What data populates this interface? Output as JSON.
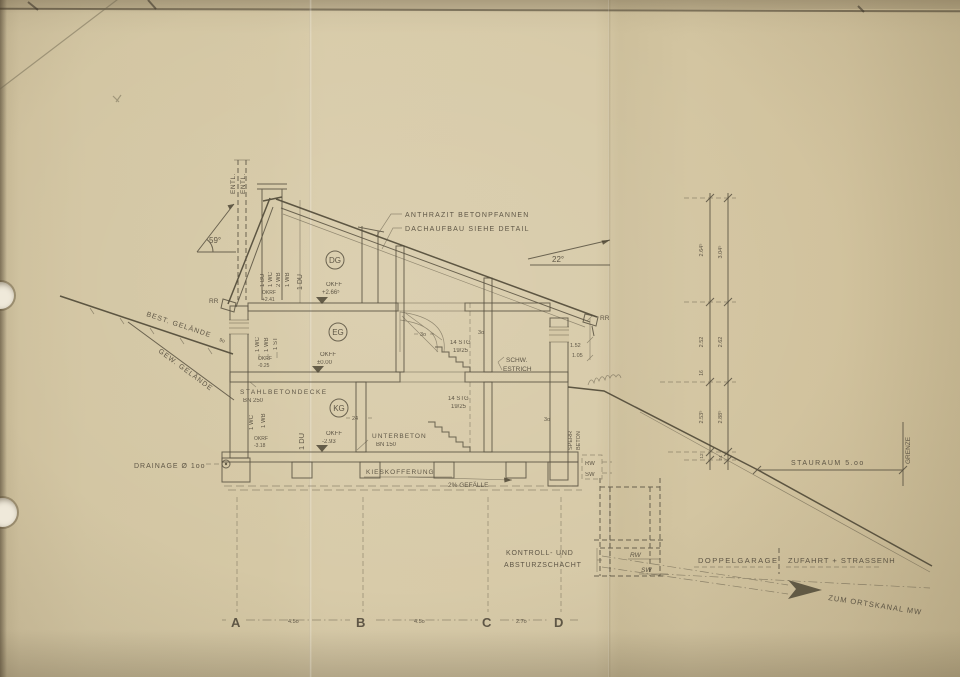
{
  "paper": {
    "bg": "#d5c8a6",
    "ink": "#57503f"
  },
  "d": {
    "vents": [
      "ENTL.",
      "ENTL."
    ],
    "angle_left": "59°",
    "angle_right": "22°",
    "roof_note1": "ANTHRAZIT BETONPFANNEN",
    "roof_note2": "DACHAUFBAU SIEHE DETAIL",
    "rr_left": "RR",
    "rr_right": "RR",
    "terrain_existing": "BEST. GELÄNDE",
    "terrain_existing_dim": "9o",
    "terrain_new": "GEW. GELÄNDE",
    "storey_dg": "DG",
    "storey_eg": "EG",
    "storey_kg": "KG",
    "lvl_dg1": "OKFF",
    "lvl_dg2": "+2.66⁵",
    "lvl_eg1": "OKFF",
    "lvl_eg2": "±0.00",
    "lvl_kg1": "OKFF",
    "lvl_kg2": "-2.93",
    "sub_dg1": "OKRF",
    "sub_dg2": "+2.41",
    "sub_eg1": "OKRF",
    "sub_eg2": "-0.25",
    "sub_kg1": "OKRF",
    "sub_kg2": "-3.18",
    "fixtures_dg": [
      "1 BU",
      "1 WC",
      "2 WB",
      "1 WB",
      "1 DU"
    ],
    "fixtures_eg": [
      "1 WC",
      "1 WB",
      "1 ST"
    ],
    "fixtures_kg": [
      "1 WC",
      "1 WB",
      "1 DU"
    ],
    "slab_note1": "STAHLBETONDECKE",
    "slab_note2": "BN 250",
    "base_note1": "UNTERBETON",
    "base_note2": "BN 150",
    "screed1": "SCHW.",
    "screed2": "ESTRICH",
    "stair1a": "14 STG",
    "stair1b": "19/25",
    "stair2a": "14 STG",
    "stair2b": "19/25",
    "wall_dims": [
      "3o",
      "3o",
      "24",
      "3o"
    ],
    "eave_dims": [
      "1.52",
      "1.05"
    ],
    "sperr1": "SPERR",
    "sperr2": "BETON",
    "rw1": "RW",
    "sw1": "SW",
    "drainage": "DRAINAGE Ø 1oo",
    "gravel": "KIESKOFFERUNG",
    "slope_note": "2% GEFÄLLE",
    "shaft1": "KONTROLL- UND",
    "shaft2": "ABSTURZSCHACHT",
    "rw2": "RW",
    "sw2": "SW",
    "garage": "DOPPELGARAGE",
    "driveway": "ZUFAHRT + STRASSENH",
    "sewer_arrow": "ZUM ORTSKANAL MW",
    "stauraum": "STAURAUM 5.oo",
    "grenze": "GRENZE",
    "axes": [
      "A",
      "B",
      "C",
      "D"
    ],
    "axis_dims": [
      "4.5o",
      "4.5o",
      "2.7o"
    ],
    "chain": {
      "s1l": "2.64⁵",
      "s1r": "3.04⁵",
      "s2l": "2.52",
      "s2r": "2.62",
      "slab": "16",
      "s3l": "2.53⁵",
      "s3r": "2.88⁵",
      "b1": "12",
      "b2": "24"
    }
  }
}
